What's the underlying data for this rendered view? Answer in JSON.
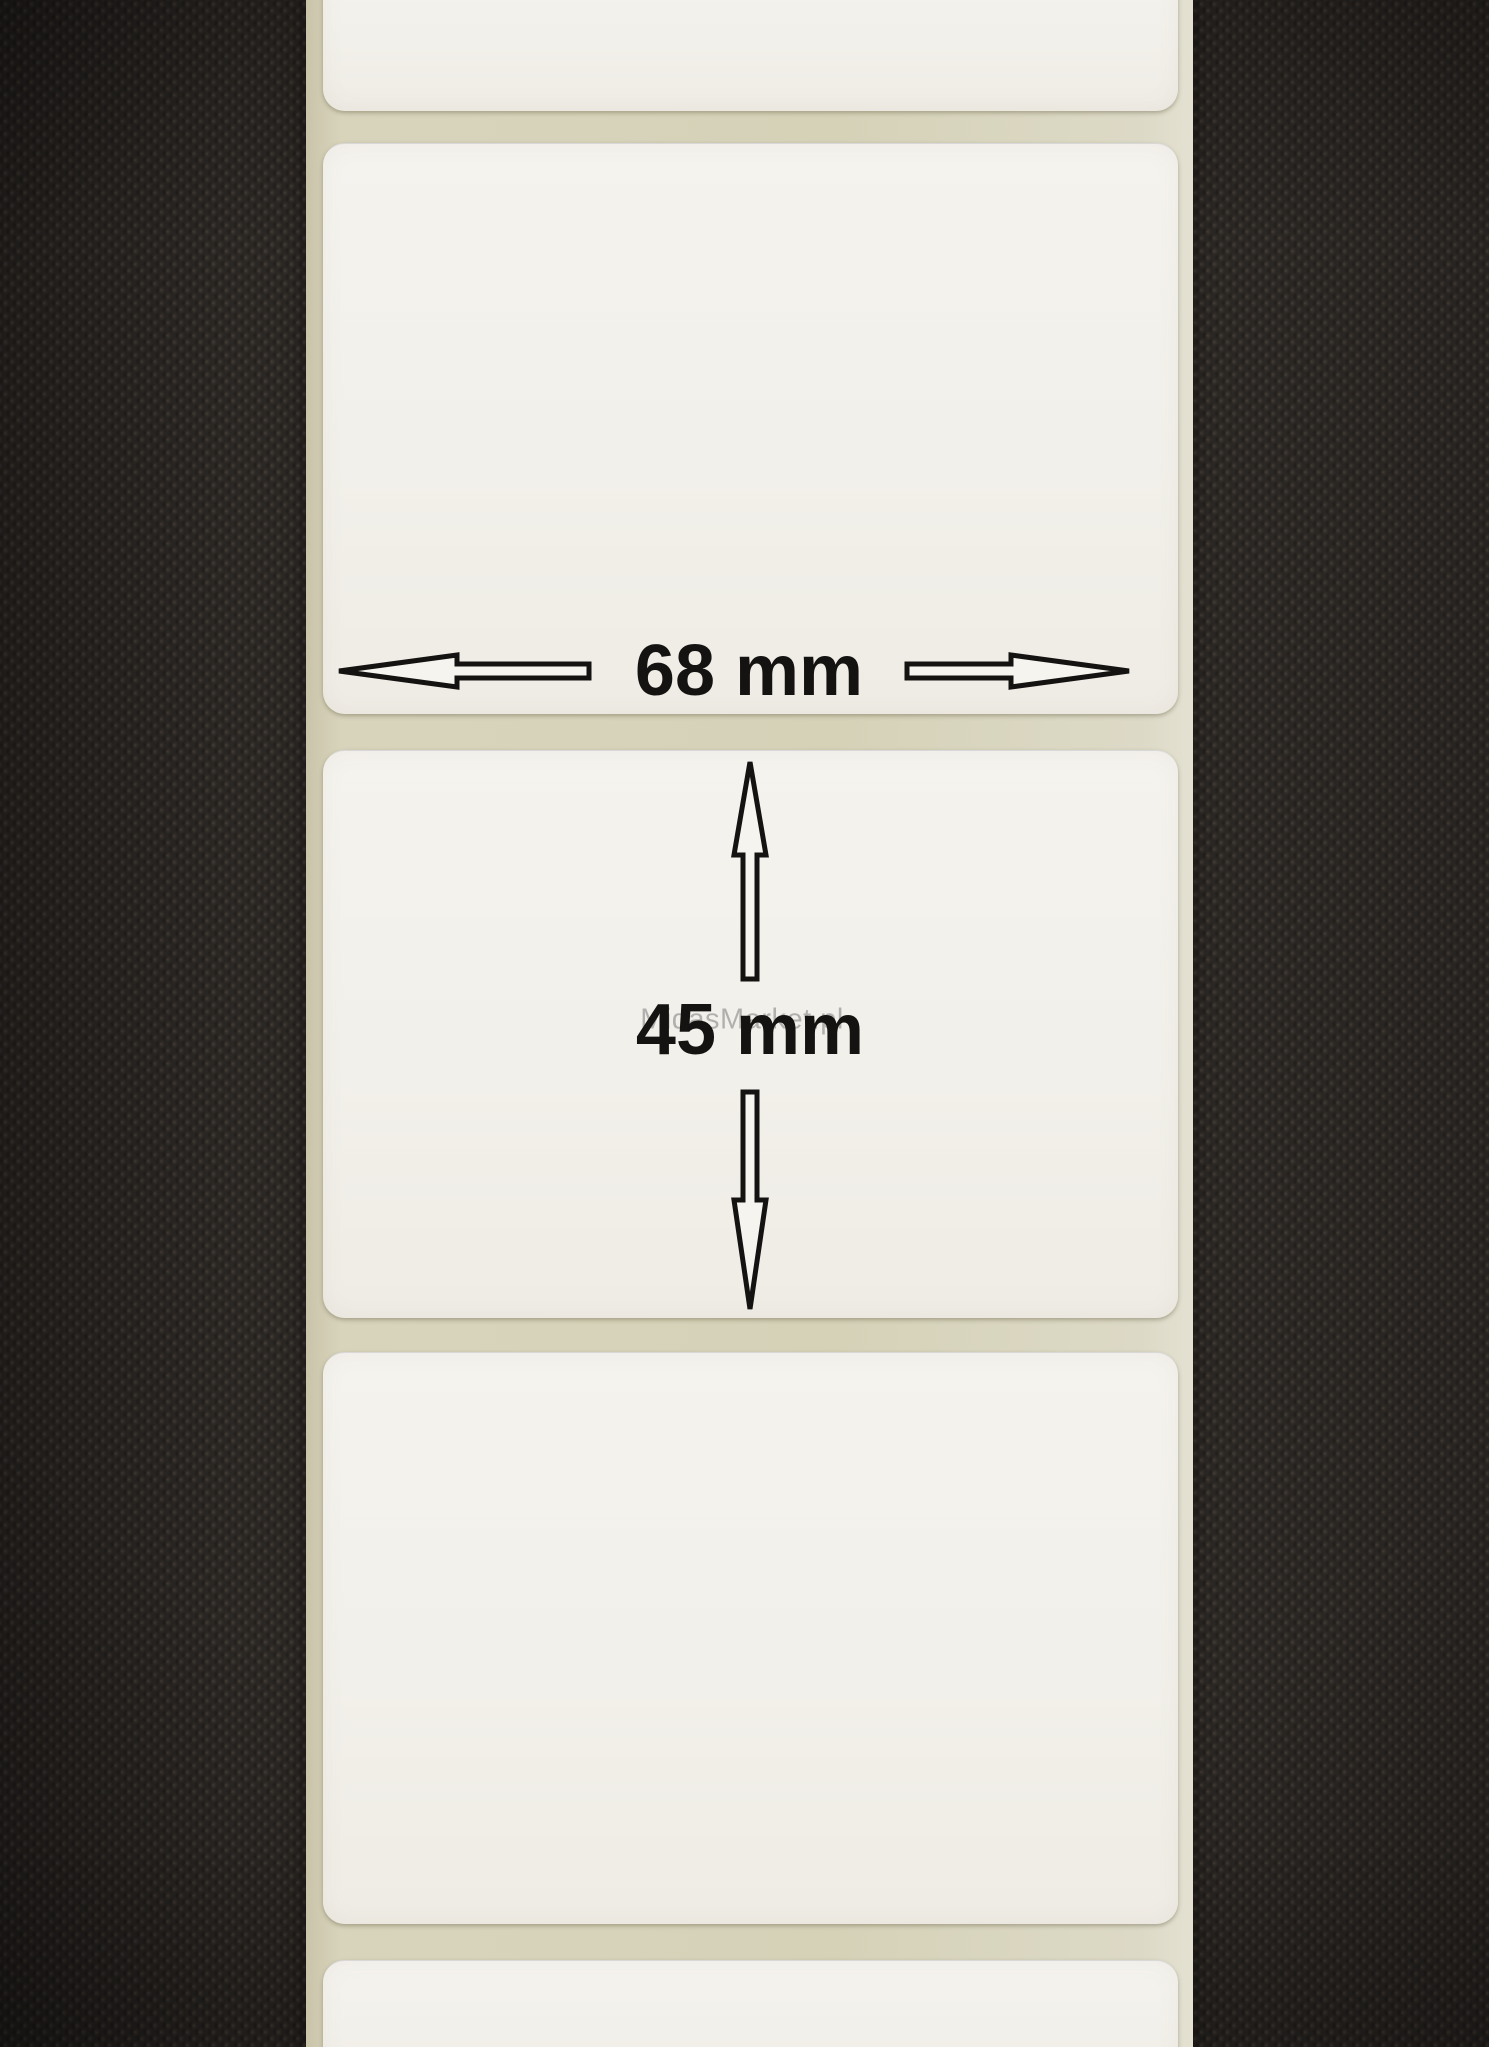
{
  "scene": {
    "description": "Roll of blank white self-adhesive thermal labels on a beige release liner, photographed on a dark knobbed rubber-textured surface",
    "visible_label_segments": 5,
    "full_labels_visible": 3
  },
  "annotations": {
    "width_label": "68 mm",
    "height_label": "45 mm"
  },
  "watermark": "MidasMarket.pl",
  "colors": {
    "background": "#2b2724",
    "liner": "#d6d2ba",
    "label": "#f2f0ea",
    "annotation": "#151312",
    "watermark_color": "#7d7d7d"
  }
}
